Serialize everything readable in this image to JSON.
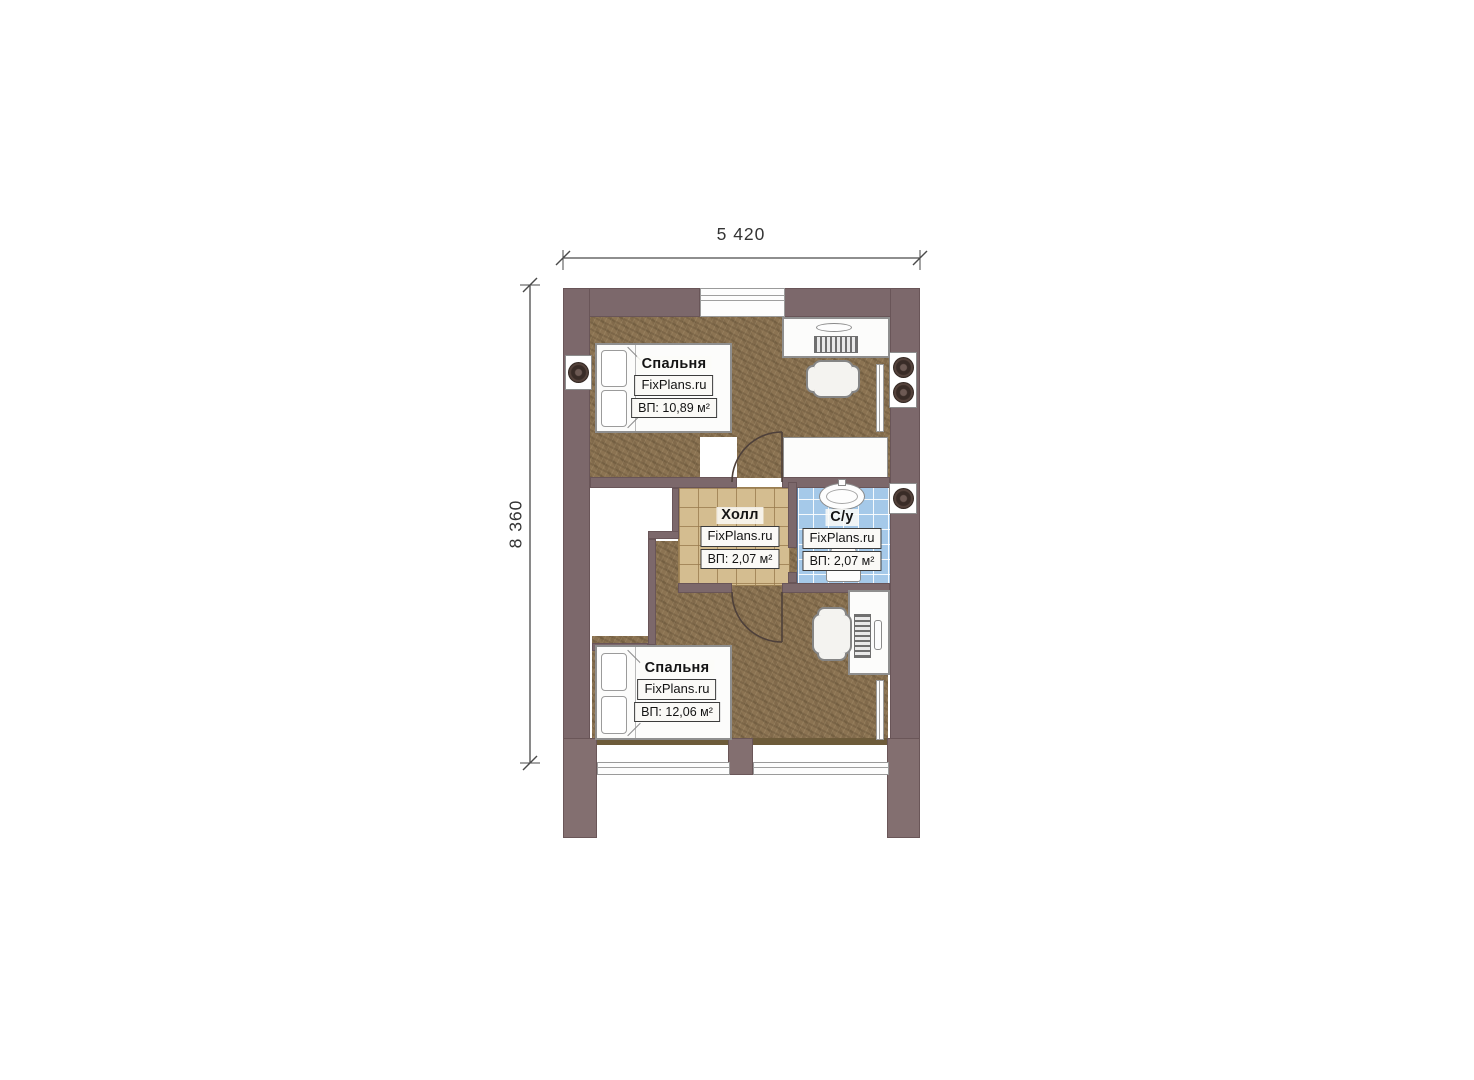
{
  "plan": {
    "dimensions": {
      "width": "5 420",
      "height": "8 360"
    },
    "rooms": {
      "bedroom_top": {
        "name": "Спальня",
        "brand": "FixPlans.ru",
        "area": "ВП: 10,89 м²"
      },
      "hall": {
        "name": "Холл",
        "brand": "FixPlans.ru",
        "area": "ВП: 2,07 м²"
      },
      "bathroom": {
        "name": "С/у",
        "brand": "FixPlans.ru",
        "area": "ВП: 2,07 м²"
      },
      "bedroom_bottom": {
        "name": "Спальня",
        "brand": "FixPlans.ru",
        "area": "ВП: 12,06 м²"
      }
    },
    "colors": {
      "wall": "#7c686b",
      "wood_floor": "#8b7352",
      "hall_tile": "#d4bd90",
      "bath_tile": "#a5c9e9"
    }
  }
}
